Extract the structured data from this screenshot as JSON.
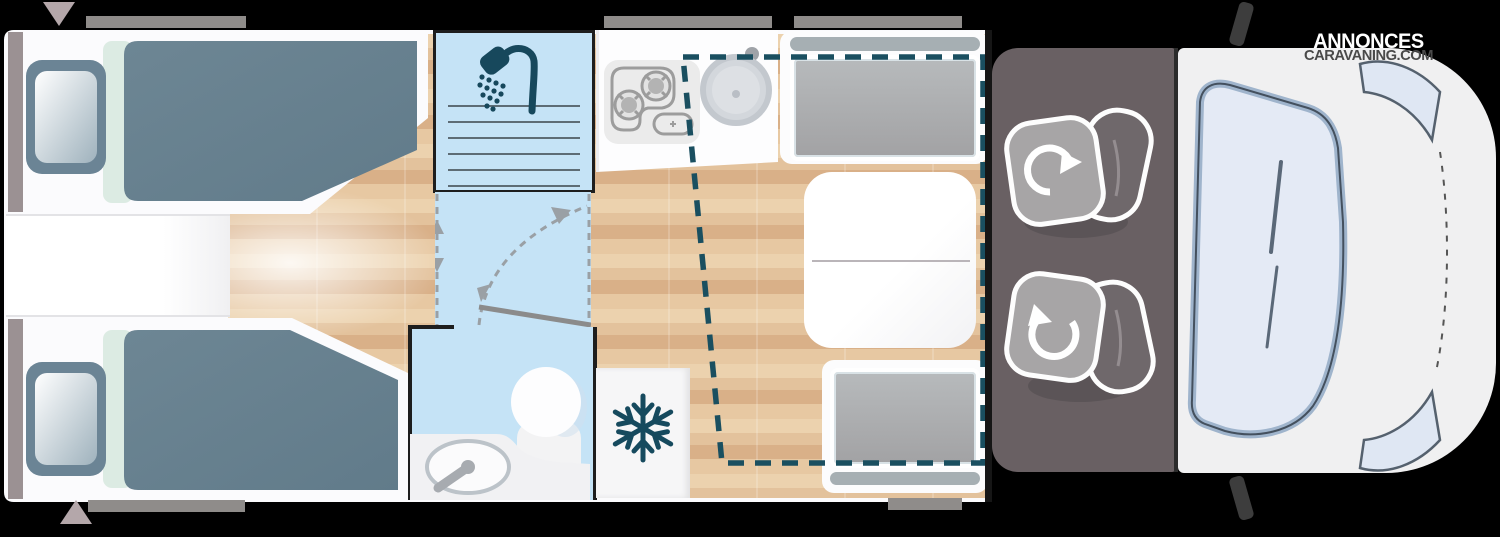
{
  "watermark": {
    "line1": "ANNONCES",
    "line2": "CARAVANING.COM"
  },
  "diagram": {
    "kind": "motorhome-floor-plan-top-view",
    "zones": [
      {
        "name": "rear-bedroom",
        "furniture": [
          "twin-bed-top",
          "twin-bed-bottom",
          "pillow",
          "pillow",
          "center-step-cabinet"
        ]
      },
      {
        "name": "shower-room",
        "icon": "shower-head-icon",
        "detail": "shower tray lines"
      },
      {
        "name": "corridor",
        "markings": [
          "sliding-door-line",
          "door-swing-arc",
          "dashed-track-arrows"
        ]
      },
      {
        "name": "washroom",
        "furniture": [
          "washbasin",
          "toilet"
        ]
      },
      {
        "name": "kitchen",
        "furniture": [
          "two-burner-hob",
          "round-sink-with-faucet"
        ]
      },
      {
        "name": "fridge",
        "icon": "snowflake-icon"
      },
      {
        "name": "dinette",
        "furniture": [
          "bench-seat-top",
          "bench-seat-bottom",
          "table"
        ],
        "overlay": "drop-down-bed-dashed-outline"
      },
      {
        "name": "cab",
        "furniture": [
          "swivel-seat-driver",
          "swivel-seat-passenger"
        ],
        "icons": [
          "rotation-arrow",
          "rotation-arrow"
        ],
        "glazing": [
          "windshield",
          "side-window-top",
          "side-window-bottom"
        ],
        "mirrors": 2
      }
    ],
    "exterior": {
      "windows_top": 3,
      "windows_bottom": 2,
      "entry_door_markers": 2
    }
  },
  "colors": {
    "bg": "#000000",
    "body": "#fbfbfd",
    "wetroom": "#c5e3f6",
    "teal_icon": "#17485c",
    "dashed_bed_outline": "#1a4f60",
    "bed_duvet": "#67808f",
    "bed_mint": "#dcebe3",
    "rear_strip": "#9b9193",
    "cushion_gray": "#a7a7a8",
    "backrest_gray": "#a6afb3",
    "cab_floor": "#696063",
    "seat_cushion": "#a7a5a6",
    "seat_back": "#6f686b",
    "hood": "#f0f0f1",
    "glass": "#e4eaf5",
    "glass_edge": "#9fb4cc",
    "wood_mid": "#e3c29c",
    "window_bar": "#8f8c8a",
    "door_marker": "#b4a7aa",
    "mirror": "#3d3d3d",
    "watermark_line2": "#4a4a4a"
  }
}
